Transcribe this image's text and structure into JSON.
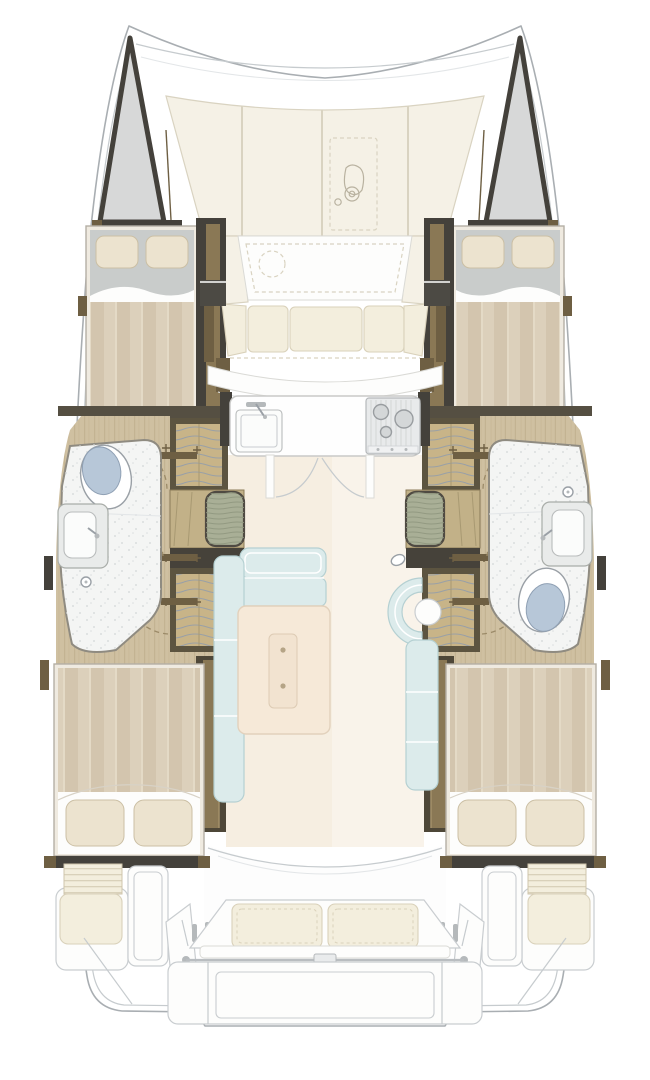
{
  "diagram": {
    "type": "floorplan",
    "subject": "catamaran deck layout, plan view, bow up",
    "visible_counts": {
      "double_beds": 4,
      "toilets": 2,
      "showers": 2,
      "sinks_bath": 2,
      "galley_sink": 1,
      "stove": 1,
      "wardrobes": 4,
      "dining_table": 1
    }
  },
  "regions": [
    "port-bow-locker",
    "starboard-bow-locker",
    "foredeck-sunpads",
    "windlass",
    "forward-cockpit",
    "port-forward-cabin",
    "starboard-forward-cabin",
    "galley",
    "port-head",
    "starboard-head",
    "port-wardrobes",
    "starboard-wardrobes",
    "salon",
    "dining-table",
    "chaise-seat",
    "port-aft-cabin",
    "starboard-aft-cabin",
    "port-companionway-steps",
    "starboard-companionway-steps",
    "aft-cockpit-bench",
    "transom-platform"
  ],
  "palette": {
    "bg": "#ffffff",
    "outline": "#a9aeb2",
    "outline_soft": "#c6cbce",
    "faint": "#e3e6e8",
    "bow": "#d7d8d8",
    "dark": "#44413b",
    "dkgray": "#4c4a44",
    "wood_dark": "#554f42",
    "wood_mid": "#6e5f43",
    "wood_face": "#8a7855",
    "wood_hi": "#a3906a",
    "tan": "#c8b488",
    "hanger": "#9aa0a6",
    "floor_wood": "#cfc0a1",
    "floor_grain": "#c1b08f",
    "stripe_a": "#dcd0bb",
    "stripe_b": "#d3c5ae",
    "bedframe": "#efeae0",
    "bedframe_line": "#b4afa5",
    "sheet": "#c9cccb",
    "pillow": "#ece3cf",
    "pillow_line": "#cbbfa4",
    "linen": "#f3eedd",
    "linen_line": "#d9d1ba",
    "sunpad": "#f5f1e6",
    "sunpad_line": "#d9d3c1",
    "white_soft": "#fdfdfc",
    "gray_line": "#c9cdd0",
    "gray_mid": "#b5b9bb",
    "steel": "#9aa0a6",
    "blue": "#dcebeb",
    "blue_line": "#b5d0d2",
    "table": "#f6e9d8",
    "table_line": "#e2d1bc",
    "salon_floor": "#f6eee1",
    "salon_floor_hi": "#f9f3ea",
    "green": "#a9af96",
    "green_line": "#8f977f",
    "lid": "#b7c7d8",
    "bath": "#f4f5f4",
    "bath_line": "#8f8b81",
    "speckle": "#d4d7d8",
    "counter": "#fefefe",
    "counter_line": "#c9c9c7",
    "stove": "#e8eaeb",
    "stove_line": "#b5b8ba",
    "dash": "#9b8a68"
  }
}
